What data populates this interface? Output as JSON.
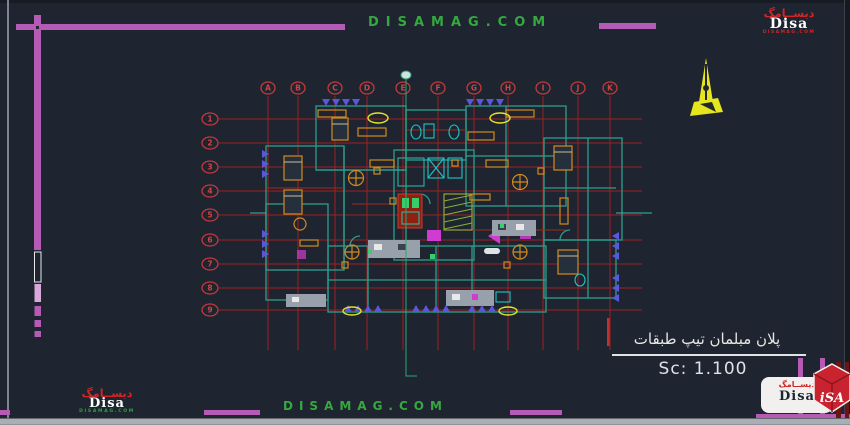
{
  "canvas": {
    "width": 850,
    "height": 425
  },
  "palette": {
    "background": "#1e2531",
    "frame_magenta": "#b55ab5",
    "frame_pink": "#d9a7d9",
    "grid_red": "#9e2020",
    "bubble_red": "#c23a3a",
    "web_green": "#35a83f",
    "wall_teal": "#2e9d8c",
    "furniture_orange": "#d28a1e",
    "fixture_cyan": "#1ec4c4",
    "hatch_blue": "#5b57dd",
    "accent_yellow": "#e4e32b",
    "blob_magenta": "#cf3ccf",
    "core_red": "#8e2110",
    "title_white": "#e8e6e2",
    "logo_red": "#d42525"
  },
  "header": {
    "website": "DISAMAG.COM"
  },
  "footer": {
    "website": "DISAMAG.COM"
  },
  "title_block": {
    "title": "پلان مبلمان تیپ طبقات",
    "scale": "Sc: 1.100"
  },
  "grid": {
    "columns": [
      {
        "label": "A",
        "x": 268
      },
      {
        "label": "B",
        "x": 298
      },
      {
        "label": "C",
        "x": 335
      },
      {
        "label": "D",
        "x": 367
      },
      {
        "label": "E",
        "x": 403
      },
      {
        "label": "F",
        "x": 438
      },
      {
        "label": "G",
        "x": 474
      },
      {
        "label": "H",
        "x": 508
      },
      {
        "label": "I",
        "x": 543
      },
      {
        "label": "J",
        "x": 578
      },
      {
        "label": "K",
        "x": 610
      }
    ],
    "rows": [
      {
        "label": "1",
        "y": 119
      },
      {
        "label": "2",
        "y": 143
      },
      {
        "label": "3",
        "y": 167
      },
      {
        "label": "4",
        "y": 191
      },
      {
        "label": "5",
        "y": 215
      },
      {
        "label": "6",
        "y": 240
      },
      {
        "label": "7",
        "y": 264
      },
      {
        "label": "8",
        "y": 288
      },
      {
        "label": "9",
        "y": 310
      }
    ],
    "column_bubble_y": 88,
    "row_bubble_x": 210,
    "v_top": 96,
    "v_bottom": 350,
    "h_left": 219,
    "h_right": 642
  },
  "logos": {
    "top_right": {
      "arabic": "دیســامگ",
      "brand": "Disa",
      "site": "DISAMAG.COM"
    },
    "bottom_left": {
      "arabic": "دیســامگ",
      "brand": "Disa",
      "site": "DISAMAG.COM"
    },
    "bottom_right": {
      "arabic": "دیســامگ",
      "brand": "Disa",
      "cube_label": "iSA"
    }
  }
}
